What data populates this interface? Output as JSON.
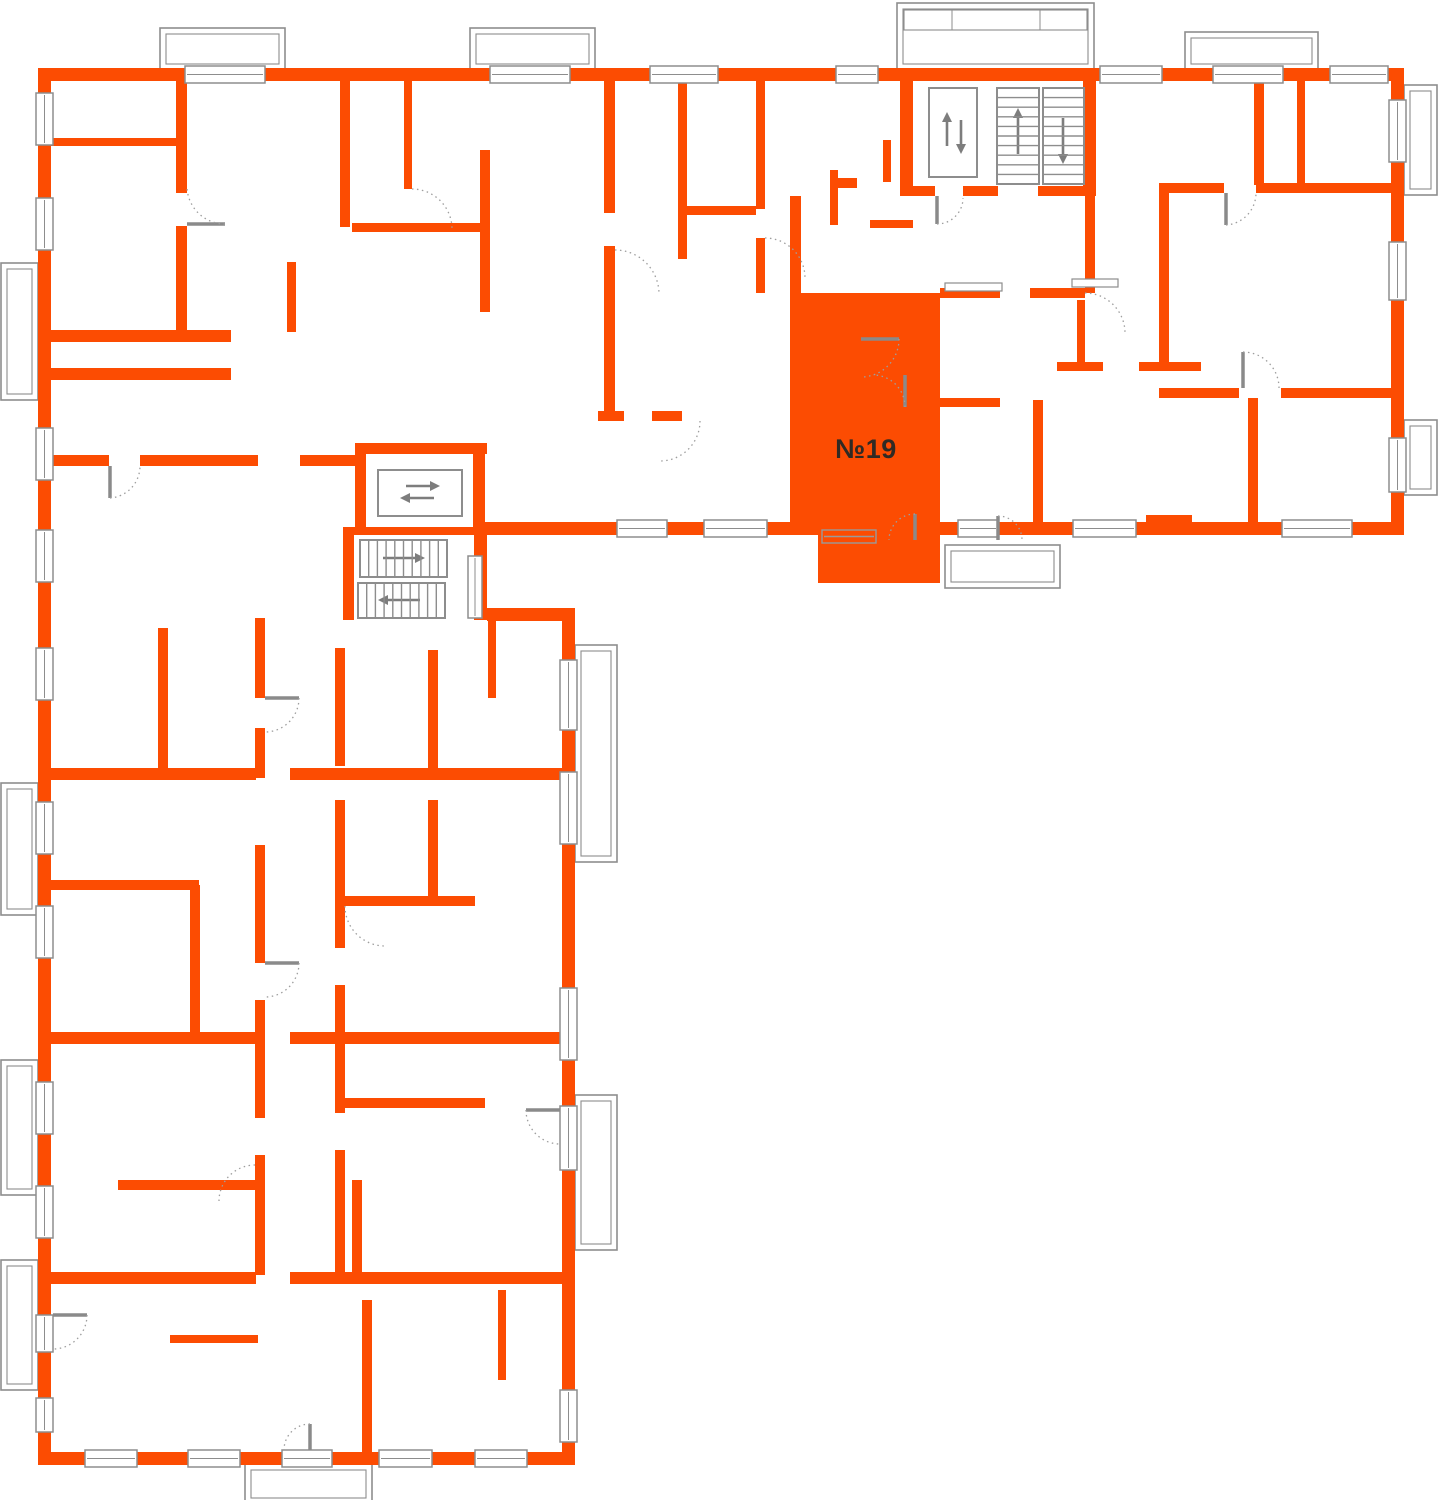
{
  "page": {
    "kind": "residential-floor-plan"
  },
  "floorplan": {
    "highlighted_apartment": {
      "label": "№19"
    },
    "cores": {
      "top": {
        "elevator_icon": "elevator-up-down-arrows",
        "stairs_up_icon": "stairs-up-arrow",
        "stairs_down_icon": "stairs-down-arrow"
      },
      "side": {
        "elevator_icon": "elevator-left-right-arrows",
        "stairs_right_icon": "stairs-right-arrow",
        "stairs_left_icon": "stairs-left-arrow"
      }
    }
  },
  "colors": {
    "wall": "#fc4c02",
    "apartment-fill": "#fc4c02",
    "line": "#8d8d8d",
    "arc": "#9e9e9e",
    "label": "#302a24",
    "bg": "#ffffff"
  }
}
